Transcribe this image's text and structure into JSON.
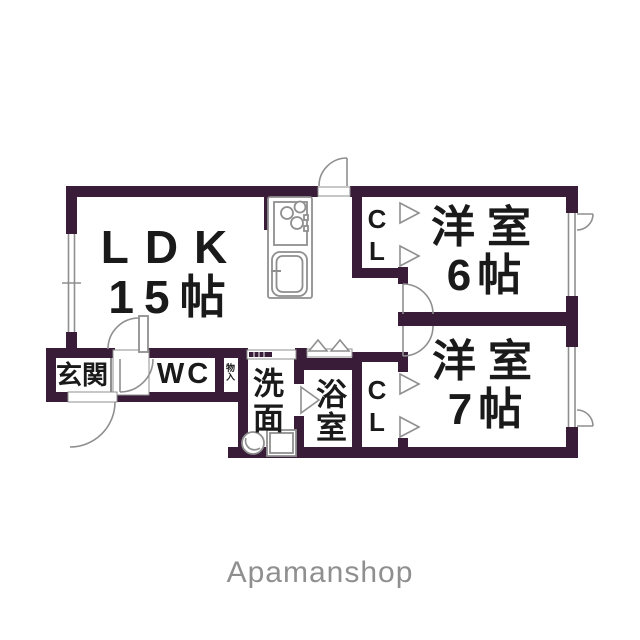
{
  "colors": {
    "wall": "#381c38",
    "line": "#8f8f8f",
    "text": "#1a1a1a",
    "watermark": "#8f8f8f",
    "bg": "#ffffff"
  },
  "rooms": {
    "ldk": {
      "name": "LDK",
      "size": "15帖"
    },
    "western_6": {
      "name": "洋室",
      "size": "6帖"
    },
    "western_7": {
      "name": "洋室",
      "size": "7帖"
    },
    "entrance": {
      "name": "玄関"
    },
    "toilet": {
      "name": "WC"
    },
    "washroom": {
      "name": "洗面"
    },
    "bathroom": {
      "name": "浴室"
    },
    "closet_top": {
      "name": "CL"
    },
    "closet_bottom": {
      "name": "CL"
    },
    "storage": {
      "name": "物入"
    }
  },
  "fixtures": [
    "stove-burners-icon",
    "kitchen-sink-icon",
    "washbasin-icon",
    "washing-machine-icon",
    "door-swing-icon",
    "folding-door-icon",
    "window-icon",
    "sliding-door-icon"
  ],
  "watermark": "Apamanshop"
}
